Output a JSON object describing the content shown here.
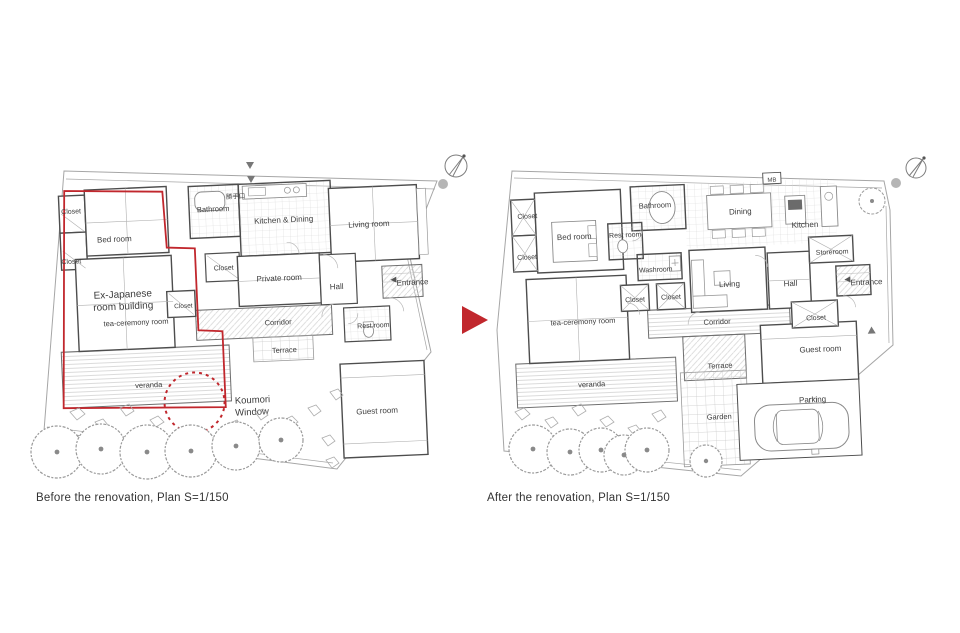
{
  "transition": {
    "arrow_color": "#c1272d"
  },
  "accent_red": "#c1272d",
  "before": {
    "caption": "Before the renovation, Plan S=1/150",
    "labels": {
      "closet_1": "Closet",
      "bed_room": "Bed room",
      "closet_2": "Closet",
      "bathroom": "Bathroom",
      "katteguchi": "勝手口",
      "kitchen_dining": "Kitchen & Dining",
      "living_room": "Living room",
      "closet_3": "Closet",
      "private_room": "Private room",
      "hall": "Hall",
      "entrance": "Entrance",
      "closet_4": "Closet",
      "tea_ceremony": "tea-ceremony room",
      "corridor": "Corridor",
      "rest_room": "Rest room",
      "terrace": "Terrace",
      "veranda": "veranda",
      "guest_room": "Guest room"
    },
    "annotations": {
      "building_line1": "Ex-Japanese",
      "building_line2": "room building",
      "koumori_line1": "Koumori",
      "koumori_line2": "Window"
    }
  },
  "after": {
    "caption": "After the renovation, Plan S=1/150",
    "labels": {
      "closet_1": "Closet",
      "bed_room": "Bed room",
      "closet_2": "Closet",
      "bathroom": "Bathroom",
      "rest_room": "Rest room",
      "washroom": "Washroom",
      "mb": "MB",
      "dining": "Dining",
      "kitchen": "Kitchen",
      "storeroom": "Storeroom",
      "closet_3": "Closet",
      "closet_4": "Closet",
      "living": "Living",
      "hall": "Hall",
      "entrance": "Entrance",
      "tea_ceremony": "tea-ceremony room",
      "corridor": "Corridor",
      "closet_5": "Closet",
      "veranda": "veranda",
      "terrace": "Terrace",
      "guest_room": "Guest room",
      "garden": "Garden",
      "parking": "Parking"
    }
  }
}
